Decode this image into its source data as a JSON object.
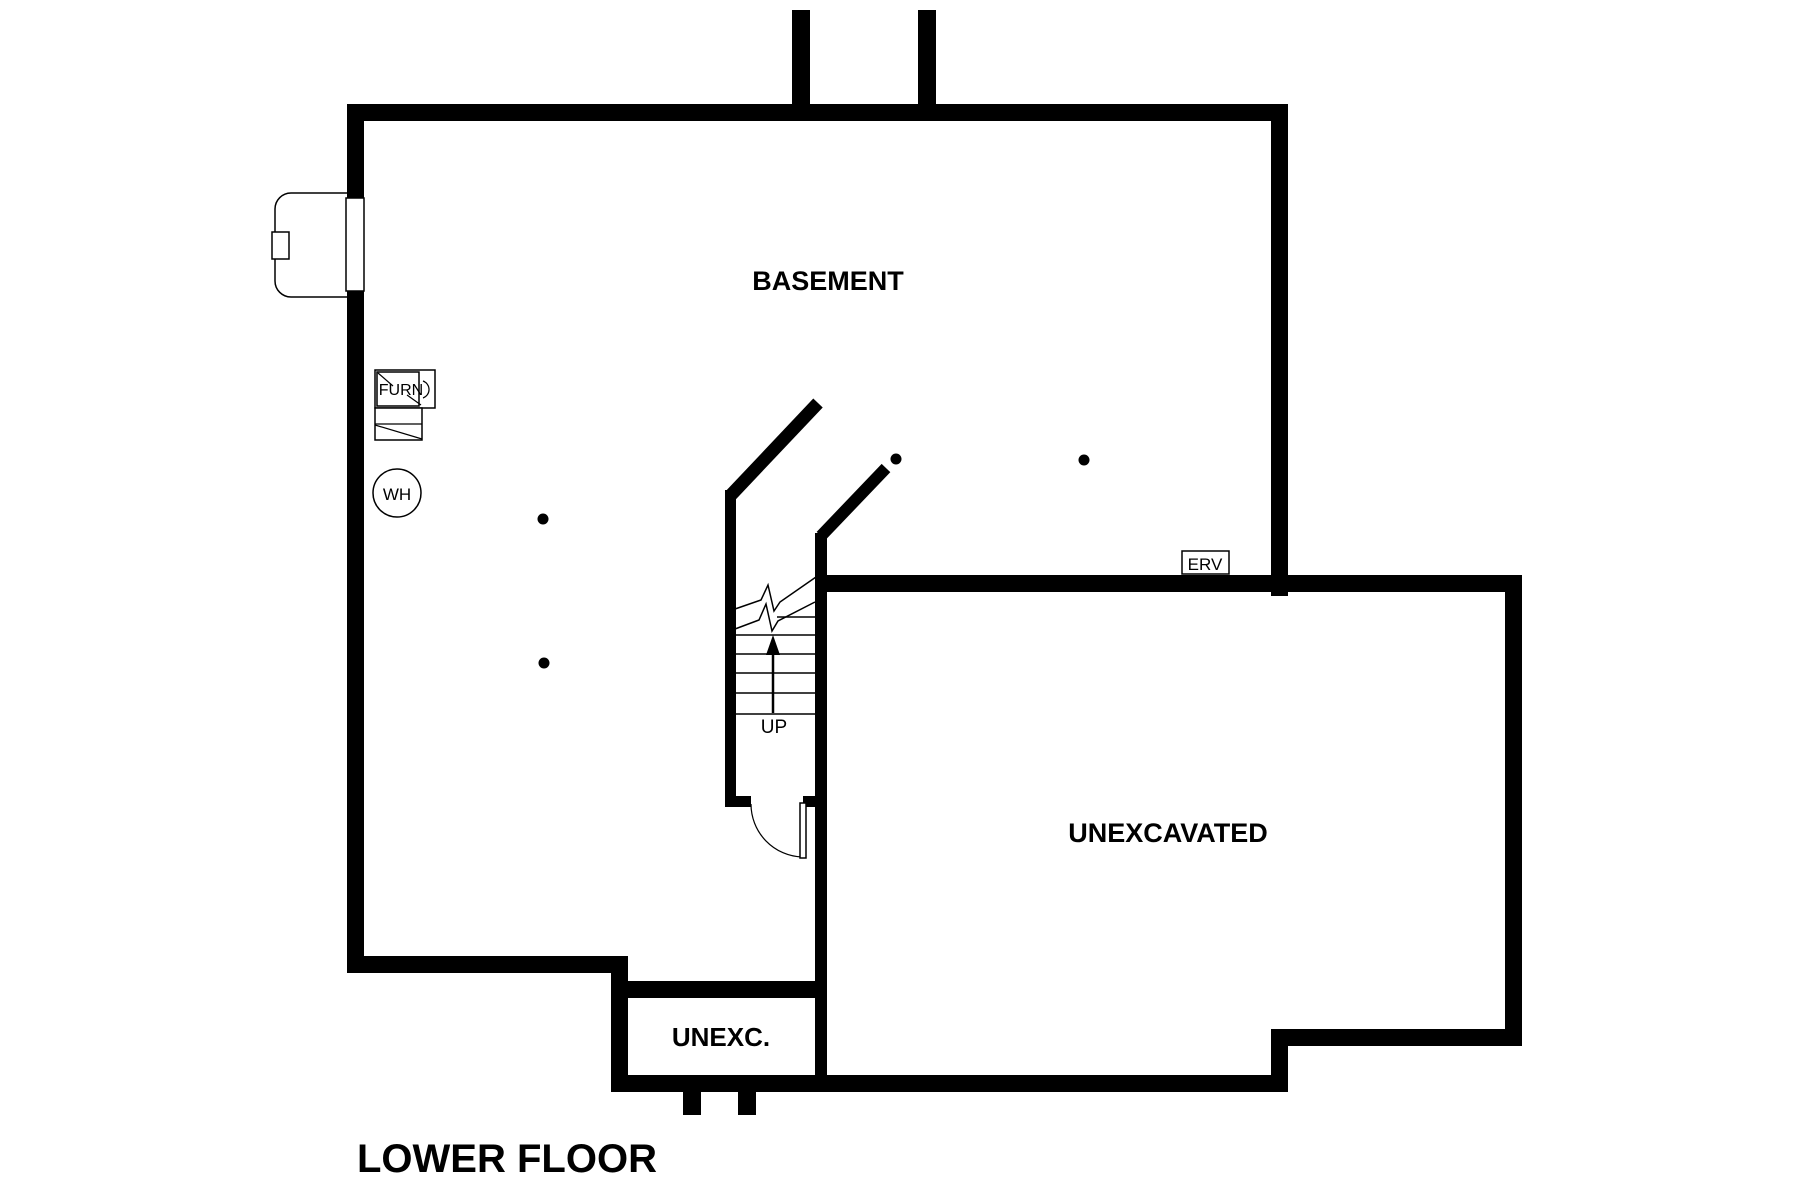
{
  "page": {
    "background_color": "#ffffff",
    "line_color": "#000000"
  },
  "plan": {
    "title": "LOWER FLOOR",
    "rooms": [
      {
        "id": "basement",
        "label": "BASEMENT"
      },
      {
        "id": "unexcavated",
        "label": "UNEXCAVATED"
      },
      {
        "id": "unexc_small",
        "label": "UNEXC."
      }
    ],
    "fixtures": {
      "furnace_label": "FURN",
      "water_heater_label": "WH",
      "erv_label": "ERV"
    },
    "stairs": {
      "direction_label": "UP"
    }
  }
}
